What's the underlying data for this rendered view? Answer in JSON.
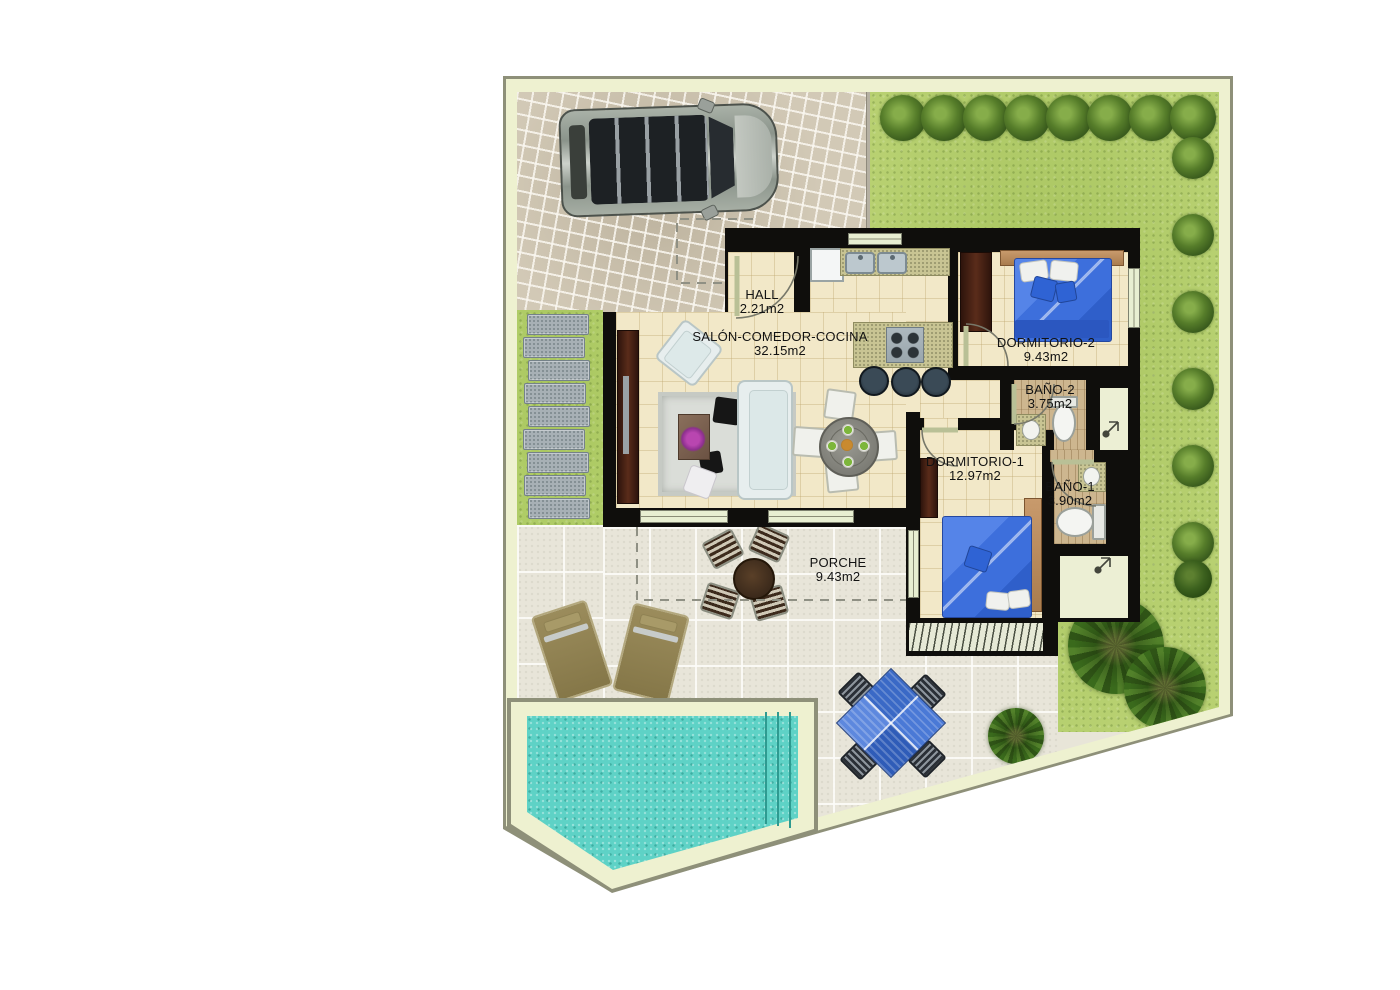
{
  "rooms": {
    "hall": {
      "name": "HALL",
      "area": "2.21m2"
    },
    "salon": {
      "name": "SALÓN-COMEDOR-COCINA",
      "area": "32.15m2"
    },
    "dormitorio2": {
      "name": "DORMITORIO-2",
      "area": "9.43m2"
    },
    "bano2": {
      "name": "BAÑO-2",
      "area": "3.75m2"
    },
    "dormitorio1": {
      "name": "DORMITORIO-1",
      "area": "12.97m2"
    },
    "bano1": {
      "name": "BAÑO-1",
      "area": "3.90m2"
    },
    "porche": {
      "name": "PORCHE",
      "area": "9.43m2"
    }
  },
  "colors": {
    "plot_border": "#eef1d0",
    "wall": "#0f0e0c",
    "floor": "#f2e8c8",
    "grass": "#afca66",
    "patio": "#e8e5d9",
    "pool": "#5ed2c6",
    "bed": "#3d6fdc",
    "label_text": "#121212"
  }
}
